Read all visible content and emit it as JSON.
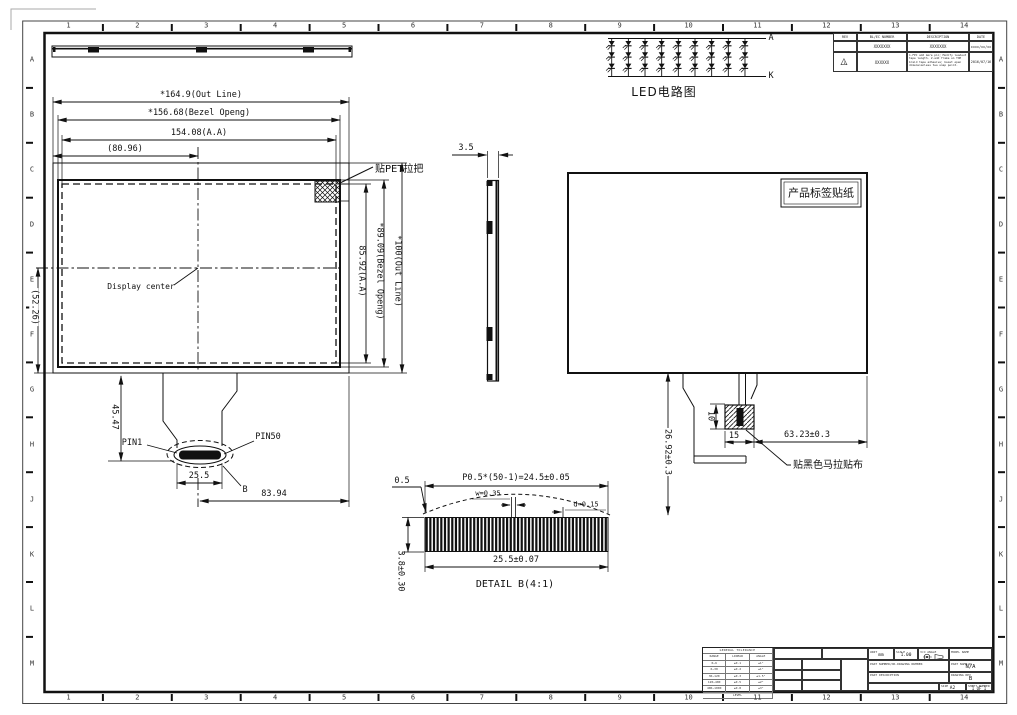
{
  "frame": {
    "columns": [
      "1",
      "2",
      "3",
      "4",
      "5",
      "6",
      "7",
      "8",
      "9",
      "10",
      "11",
      "12",
      "13",
      "14"
    ],
    "rows": [
      "A",
      "B",
      "C",
      "D",
      "E",
      "F",
      "G",
      "H",
      "J",
      "K",
      "L",
      "M"
    ]
  },
  "revision_table": {
    "headers": {
      "rev": "REV",
      "number": "BL/EC NUMBER",
      "description": "DESCRIPTION",
      "date": "DATE"
    },
    "rows": [
      {
        "rev": "",
        "number": "XXXXXXX",
        "description": "XXXXXXX",
        "date": "xxxx/xx/xx"
      },
      {
        "rev": "1",
        "number": "XXXXXX",
        "description": "1.FPC add more pin; Modify leadout tape length. 2.add frame on TOP braid tape adhesive; boost open dimensionless two snap point.",
        "date": "2016/07/16"
      }
    ]
  },
  "led_circuit": {
    "title": "LED电路图",
    "anode_label": "A",
    "cathode_label": "K",
    "columns": 9,
    "rows": 3
  },
  "front_view": {
    "dim_outline_width": "*164.9(Out Line)",
    "dim_bezel_width": "*156.68(Bezel Openg)",
    "dim_aa_width": "154.08(A.A)",
    "dim_center_x": "(80.96)",
    "dim_outline_height": "*100(Out Line)",
    "dim_bezel_height": "*89.09(Bezel Openg)",
    "dim_aa_height": "85.92(A.A)",
    "dim_center_y": "(52.26)",
    "dim_tail_length": "45.47",
    "dim_connector_width": "25.5",
    "dim_connector_offset": "83.94",
    "label_pet_tab": "贴PET拉把",
    "label_display_center": "Display center",
    "label_pin1": "PIN1",
    "label_pin50": "PIN50",
    "label_detail_mark": "B"
  },
  "side_view": {
    "dim_thickness": "3.5"
  },
  "back_view": {
    "label_sticker": "产品标签贴纸",
    "label_mylar": "贴黑色马拉贴布",
    "dim_tail_length": "26.92±0.3",
    "dim_tab_width": "15",
    "dim_tab_offset": "63.23±0.3",
    "dim_tab_height": "10"
  },
  "detail_b": {
    "title": "DETAIL B(4:1)",
    "dim_pitch": "P0.5*(50-1)=24.5±0.05",
    "dim_pin_width": "w=0.35",
    "dim_pin_gap": "d=0.15",
    "dim_width": "25.5±0.07",
    "dim_height": "3.8±0.30",
    "dim_end_margin": "0.5",
    "pins": 50
  },
  "title_block": {
    "approved_label": "APPROVED",
    "approved": "Coll Chen",
    "checked_label": "CHECKED",
    "checked": "Xiaonan Su",
    "designed_label": "DESIGNED",
    "designed": "Yuanxiufu",
    "critical_dim_mark": "Ⓔ [MC]CRITICAL DIMENSION",
    "spec_dim_mark": "Ⓒ SPEC DIMENSION",
    "unit_label": "UNIT",
    "unit": "mm",
    "scale_label": "SCALE",
    "scale": "1.00",
    "angle_label": "3rd ANGLE",
    "model_label": "MODEL NAME",
    "part_number_label": "PART NUMBER/OR-DRAWING NUMBER",
    "part_name_label": "PART NAME(R)",
    "part_name": "N/A",
    "part_desc_label": "PART DESCRIPTION",
    "drawing_rev_label": "DRAWING REV",
    "drawing_rev": "B",
    "size_label": "SIZE",
    "size": "A2",
    "sheet_label": "SHEET NUMBER",
    "sheet": "1 OF 1",
    "slash": "/",
    "tolerance": {
      "title": "GENERAL TOLERANCE",
      "cols": [
        "RANGE",
        "LINEAR",
        "ANGLE"
      ],
      "rows": [
        [
          "0~6",
          "±0.1",
          "±1°"
        ],
        [
          "6~30",
          "±0.2",
          "±1°"
        ],
        [
          "30~120",
          "±0.3",
          "±1.5°"
        ],
        [
          "120~400",
          "±0.5",
          "±2°"
        ],
        [
          "400~1000",
          "±0.8",
          "±3°"
        ]
      ],
      "footer": "LEVEL"
    }
  }
}
